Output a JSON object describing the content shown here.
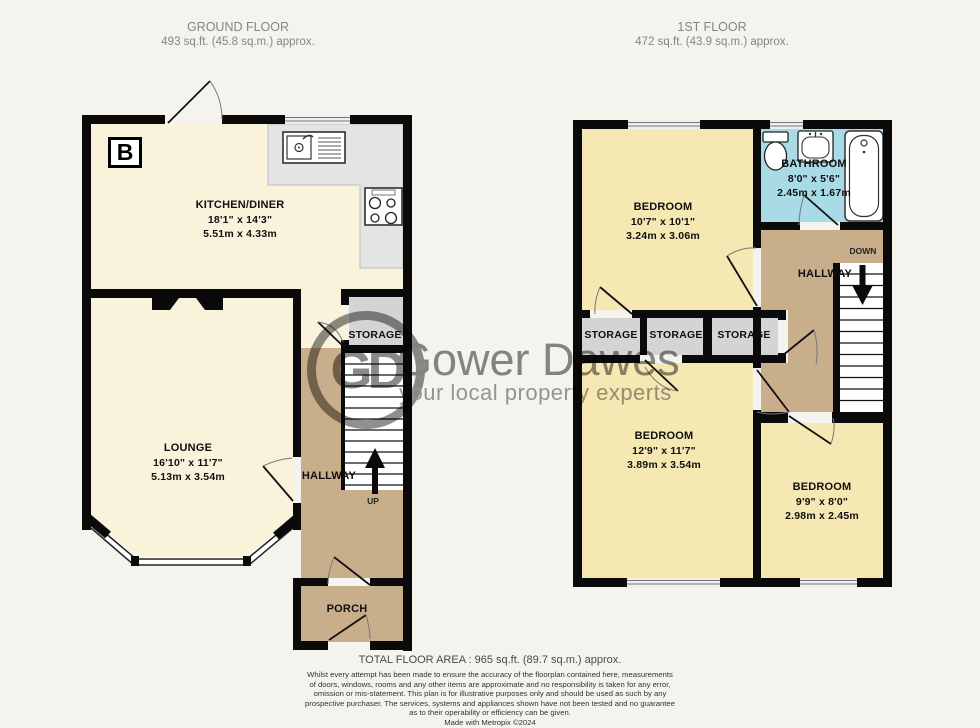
{
  "ground_floor": {
    "title": "GROUND FLOOR",
    "area": "493 sq.ft. (45.8 sq.m.) approx.",
    "compass_letter": "B",
    "kitchen": {
      "name": "KITCHEN/DINER",
      "imperial": "18'1\" x 14'3\"",
      "metric": "5.51m x 4.33m"
    },
    "lounge": {
      "name": "LOUNGE",
      "imperial": "16'10\" x 11'7\"",
      "metric": "5.13m x 3.54m"
    },
    "storage_label": "STORAGE",
    "hallway_label": "HALLWAY",
    "up_label": "UP",
    "porch_label": "PORCH"
  },
  "first_floor": {
    "title": "1ST FLOOR",
    "area": "472 sq.ft. (43.9 sq.m.) approx.",
    "bedroom1": {
      "name": "BEDROOM",
      "imperial": "10'7\" x 10'1\"",
      "metric": "3.24m x 3.06m"
    },
    "bathroom": {
      "name": "BATHROOM",
      "imperial": "8'0\" x 5'6\"",
      "metric": "2.45m x 1.67m"
    },
    "bedroom2": {
      "name": "BEDROOM",
      "imperial": "12'9\" x 11'7\"",
      "metric": "3.89m x 3.54m"
    },
    "bedroom3": {
      "name": "BEDROOM",
      "imperial": "9'9\" x 8'0\"",
      "metric": "2.98m x 2.45m"
    },
    "storage_labels": [
      "STORAGE",
      "STORAGE",
      "STORAGE"
    ],
    "hallway_label": "HALLWAY",
    "down_label": "DOWN"
  },
  "watermark": {
    "initials": "GD",
    "name": "Gower Dawes",
    "tagline": "your local property experts"
  },
  "footer": {
    "total_area": "TOTAL FLOOR AREA : 965 sq.ft. (89.7 sq.m.) approx.",
    "disclaimer_lines": [
      "Whilst every attempt has been made to ensure the accuracy of the floorplan contained here, measurements",
      "of doors, windows, rooms and any other items are approximate and no responsibility is taken for any error,",
      "omission or mis-statement. This plan is for illustrative purposes only and should be used as such by any",
      "prospective purchaser. The services, systems and appliances shown have not been tested and no guarantee",
      "as to their operability or efficiency can be given."
    ],
    "credit": "Made with Metropix ©2024"
  },
  "colors": {
    "background": "#f4f3ee",
    "wall": "#0a0a0a",
    "ground_room_cream": "#f8f3da",
    "first_room_yellow": "#f6e8b2",
    "hallway_tan": "#c9ae8b",
    "storage_gray": "#d4d4d4",
    "bathroom_blue": "#a9dbe6",
    "counter_gray": "#e4e4e4",
    "watermark_gray": "#8a8a8a"
  }
}
